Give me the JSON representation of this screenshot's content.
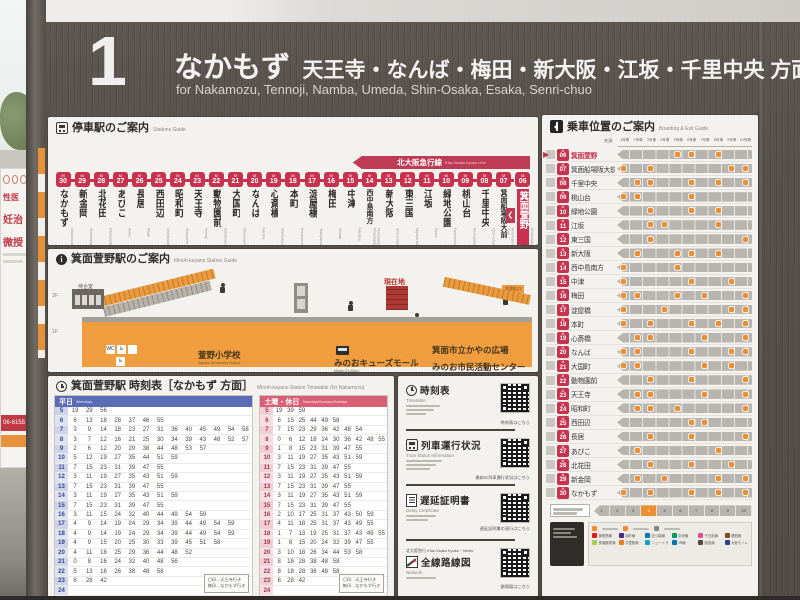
{
  "header": {
    "platform_number": "1",
    "destination_main": "なかもず",
    "destination_rest": "天王寺・なんば・梅田・新大阪・江坂・千里中央 方面",
    "destination_en": "for Nakamozu, Tennoji, Namba, Umeda, Shin-Osaka, Esaka, Senri-chuo"
  },
  "scene": {
    "poster_fragments": [
      "性医",
      "妊治",
      "微授"
    ],
    "poster_phone": "06-6155"
  },
  "route_panel": {
    "title": "停車駅のご案内",
    "title_en": "Stations Guide",
    "banner": "北大阪急行線",
    "banner_en": "Kita-Osaka Kyuko Line",
    "chevron": "❮",
    "stations": [
      {
        "num": "30",
        "name": "なかもず",
        "roma": "Nakamozu",
        "transfers": [
          "#2f6db5",
          "#8a8884"
        ]
      },
      {
        "num": "29",
        "name": "新金岡",
        "roma": "Shinkanaoka",
        "transfers": []
      },
      {
        "num": "28",
        "name": "北花田",
        "roma": "Kitahanada",
        "transfers": []
      },
      {
        "num": "27",
        "name": "あびこ",
        "roma": "Abiko",
        "transfers": []
      },
      {
        "num": "26",
        "name": "長居",
        "roma": "Nagai",
        "transfers": [
          "#0072bc"
        ]
      },
      {
        "num": "25",
        "name": "西田辺",
        "roma": "Nishitanabe",
        "transfers": []
      },
      {
        "num": "24",
        "name": "昭和町",
        "roma": "Showacho",
        "transfers": []
      },
      {
        "num": "23",
        "name": "天王寺",
        "roma": "Tennoji",
        "transfers": [
          "#0072bc",
          "#8f3e97",
          "#e5a21e",
          "#c8324e"
        ]
      },
      {
        "num": "22",
        "name": "動物園前",
        "roma": "Dobutsuen-mae",
        "transfers": [
          "#814721",
          "#e44d93",
          "#0072bc"
        ]
      },
      {
        "num": "21",
        "name": "大国町",
        "roma": "Daikokucho",
        "transfers": [
          "#0078ba"
        ]
      },
      {
        "num": "20",
        "name": "なんば",
        "roma": "Namba",
        "transfers": [
          "#0078ba",
          "#e44d93",
          "#005bac",
          "#0072bc",
          "#8c6e1e"
        ]
      },
      {
        "num": "19",
        "name": "心斎橋",
        "roma": "Shinsaibashi",
        "transfers": [
          "#a9cc51",
          "#d5c92a",
          "#0078ba"
        ]
      },
      {
        "num": "18",
        "name": "本町",
        "roma": "Hommachi",
        "transfers": [
          "#019a66",
          "#0078ba"
        ]
      },
      {
        "num": "17",
        "name": "淀屋橋",
        "roma": "Yodoyabashi",
        "transfers": [
          "#1d6fb7"
        ]
      },
      {
        "num": "16",
        "name": "梅田",
        "roma": "Umeda",
        "transfers": [
          "#0d3d8c",
          "#0072bc",
          "#59493f",
          "#c5242c"
        ]
      },
      {
        "num": "15",
        "name": "中津",
        "roma": "Nakatsu",
        "transfers": []
      },
      {
        "num": "14",
        "name": "西中島南方",
        "roma": "Nishinakajima-Minamigata",
        "transfers": [
          "#59493f",
          "#8a8884"
        ]
      },
      {
        "num": "13",
        "name": "新大阪",
        "roma": "Shin-Osaka",
        "transfers": [
          "#0072bc",
          "#00427e"
        ]
      },
      {
        "num": "12",
        "name": "東三国",
        "roma": "Higashi-Mikuni",
        "transfers": []
      },
      {
        "num": "11",
        "name": "江坂",
        "roma": "Esaka",
        "transfers": []
      },
      {
        "num": "10",
        "name": "緑地公園",
        "roma": "Ryokuchi-koen",
        "transfers": []
      },
      {
        "num": "09",
        "name": "桃山台",
        "roma": "Momoyamadai",
        "transfers": []
      },
      {
        "num": "08",
        "name": "千里中央",
        "roma": "Senri-Chuo",
        "transfers": [
          "#2f3f8f"
        ]
      },
      {
        "num": "07",
        "name": "箕面船場阪大前",
        "roma": "Minoh-semba Handai-mae",
        "transfers": []
      },
      {
        "num": "06",
        "name": "箕面萱野",
        "roma": "Minoh-kayano",
        "transfers": [],
        "current": true
      }
    ]
  },
  "map_panel": {
    "title": "箕面萱野駅のご案内",
    "title_en": "Minoh-kayano Station Guide",
    "floor2": "2F",
    "floor1": "1F",
    "current": "現在地",
    "waiting": "待合室",
    "south_gate": "南改札口",
    "south_gate_en": "South Gates",
    "north_gate": "北改札口",
    "north_gate_en": "North Gates",
    "north_tag": "北改札口",
    "school": "萱野小学校",
    "school_en": "Kayano Elementary School",
    "mall": "みのおキューズモール",
    "mall_en": "Minoh Q's MALL",
    "square": "箕面市立かやの広場",
    "center": "みのお市民活動センター",
    "wc": "WC",
    "wheelchair": "♿"
  },
  "timetable": {
    "title": "箕面萱野駅 時刻表［なかもず 方面］",
    "title_en": "Minoh-kayano Station Timetable (for Nakamozu)",
    "revision": "2024.3.23改正",
    "legend": [
      "〇印…天王寺行き",
      "無印…なかもず行き"
    ],
    "weekday": {
      "label": "平日",
      "label_en": "Weekdays",
      "rows": [
        {
          "hour": "5",
          "mins": [
            19,
            29,
            56
          ]
        },
        {
          "hour": "6",
          "mins": [
            6,
            13,
            18,
            28,
            37,
            46,
            55
          ]
        },
        {
          "hour": "7",
          "mins": [
            3,
            9,
            14,
            18,
            23,
            27,
            31,
            36,
            40,
            45,
            49,
            54,
            58
          ]
        },
        {
          "hour": "8",
          "mins": [
            3,
            7,
            12,
            16,
            21,
            25,
            30,
            34,
            39,
            43,
            48,
            52,
            57
          ]
        },
        {
          "hour": "9",
          "mins": [
            2,
            6,
            12,
            20,
            29,
            38,
            44,
            48,
            53,
            57
          ]
        },
        {
          "hour": "10",
          "mins": [
            5,
            12,
            19,
            27,
            35,
            44,
            51,
            59
          ]
        },
        {
          "hour": "11",
          "mins": [
            7,
            15,
            23,
            31,
            39,
            47,
            55
          ]
        },
        {
          "hour": "12",
          "mins": [
            3,
            11,
            19,
            27,
            35,
            43,
            51,
            59
          ]
        },
        {
          "hour": "13",
          "mins": [
            7,
            15,
            23,
            31,
            39,
            47,
            55
          ]
        },
        {
          "hour": "14",
          "mins": [
            3,
            11,
            19,
            27,
            35,
            43,
            51,
            59
          ]
        },
        {
          "hour": "15",
          "mins": [
            7,
            15,
            23,
            31,
            39,
            47,
            55
          ]
        },
        {
          "hour": "16",
          "mins": [
            3,
            11,
            15,
            24,
            32,
            40,
            44,
            49,
            54,
            59
          ]
        },
        {
          "hour": "17",
          "mins": [
            4,
            9,
            14,
            19,
            24,
            29,
            34,
            39,
            44,
            49,
            54,
            59
          ]
        },
        {
          "hour": "18",
          "mins": [
            4,
            9,
            14,
            19,
            24,
            29,
            34,
            39,
            44,
            49,
            54,
            59
          ]
        },
        {
          "hour": "19",
          "mins": [
            4,
            9,
            15,
            20,
            25,
            30,
            33,
            39,
            45,
            51,
            58
          ]
        },
        {
          "hour": "20",
          "mins": [
            4,
            11,
            18,
            25,
            29,
            36,
            44,
            48,
            52
          ]
        },
        {
          "hour": "21",
          "mins": [
            0,
            8,
            16,
            24,
            32,
            40,
            48,
            56
          ]
        },
        {
          "hour": "22",
          "mins": [
            5,
            13,
            16,
            26,
            38,
            48,
            58
          ]
        },
        {
          "hour": "23",
          "mins": [
            8,
            28,
            42
          ]
        },
        {
          "hour": "24",
          "mins": []
        }
      ]
    },
    "holiday": {
      "label": "土曜・休日",
      "label_en": "Saturdays/Sundays/Holidays",
      "rows": [
        {
          "hour": "5",
          "mins": [
            19,
            39,
            59
          ]
        },
        {
          "hour": "6",
          "mins": [
            6,
            15,
            25,
            44,
            49,
            58
          ]
        },
        {
          "hour": "7",
          "mins": [
            7,
            15,
            23,
            29,
            36,
            42,
            48,
            54
          ]
        },
        {
          "hour": "8",
          "mins": [
            0,
            6,
            12,
            18,
            24,
            30,
            36,
            42,
            48,
            55
          ]
        },
        {
          "hour": "9",
          "mins": [
            1,
            8,
            15,
            23,
            31,
            39,
            47,
            55
          ]
        },
        {
          "hour": "10",
          "mins": [
            3,
            11,
            19,
            27,
            35,
            43,
            51,
            59
          ]
        },
        {
          "hour": "11",
          "mins": [
            7,
            15,
            23,
            31,
            39,
            47,
            55
          ]
        },
        {
          "hour": "12",
          "mins": [
            3,
            11,
            19,
            27,
            35,
            43,
            51,
            59
          ]
        },
        {
          "hour": "13",
          "mins": [
            7,
            15,
            23,
            31,
            39,
            47,
            55
          ]
        },
        {
          "hour": "14",
          "mins": [
            3,
            11,
            19,
            27,
            35,
            43,
            51,
            59
          ]
        },
        {
          "hour": "15",
          "mins": [
            7,
            15,
            23,
            31,
            39,
            47,
            55
          ]
        },
        {
          "hour": "16",
          "mins": [
            2,
            10,
            17,
            25,
            31,
            37,
            43,
            50,
            59
          ]
        },
        {
          "hour": "17",
          "mins": [
            4,
            11,
            18,
            25,
            31,
            37,
            43,
            49,
            55
          ]
        },
        {
          "hour": "18",
          "mins": [
            1,
            7,
            13,
            19,
            25,
            31,
            37,
            43,
            49,
            55
          ]
        },
        {
          "hour": "19",
          "mins": [
            1,
            8,
            15,
            20,
            24,
            32,
            39,
            47,
            55
          ]
        },
        {
          "hour": "20",
          "mins": [
            3,
            10,
            18,
            26,
            34,
            44,
            53,
            58
          ]
        },
        {
          "hour": "21",
          "mins": [
            8,
            18,
            28,
            38,
            48,
            58
          ]
        },
        {
          "hour": "22",
          "mins": [
            8,
            18,
            28,
            38,
            48,
            58
          ]
        },
        {
          "hour": "23",
          "mins": [
            8,
            28,
            42
          ]
        },
        {
          "hour": "24",
          "mins": []
        }
      ]
    }
  },
  "qr": {
    "cards": [
      {
        "icon": "clock-icon",
        "title": "時刻表",
        "en": "Timetable",
        "caption": "時刻表はこちら"
      },
      {
        "icon": "train-icon",
        "title": "列車運行状況",
        "en": "Train Status Information",
        "caption": "最新の列車運行状況はこちら"
      },
      {
        "icon": "document-icon",
        "title": "遅延証明書",
        "en": "Delay Certificate",
        "caption": "遅延証明書の発行はこちら"
      },
      {
        "icon": "map-icon",
        "pre": "北大阪急行 Kita-Osaka Kyuko・Metro",
        "title": "全線路線図",
        "en": "Network",
        "caption": "路線図はこちら"
      }
    ]
  },
  "boarding": {
    "title": "乗車位置のご案内",
    "title_en": "Boarding & Exit Guide",
    "front_label": "先頭",
    "car_labels": [
      "1号車",
      "2号車",
      "3号車",
      "4号車",
      "5号車",
      "6号車",
      "7号車",
      "8号車",
      "9号車",
      "10号車"
    ],
    "rows": [
      {
        "num": "06",
        "name": "箕面萱野",
        "current": true,
        "markers": [
          5,
          6,
          8
        ]
      },
      {
        "num": "07",
        "name": "箕面船場阪大前",
        "markers": [
          1,
          3,
          9,
          10
        ]
      },
      {
        "num": "08",
        "name": "千里中央",
        "markers": [
          2,
          3,
          6,
          8,
          10
        ]
      },
      {
        "num": "09",
        "name": "桃山台",
        "markers": [
          1,
          2,
          6
        ]
      },
      {
        "num": "10",
        "name": "緑地公園",
        "markers": [
          3,
          6,
          8
        ]
      },
      {
        "num": "11",
        "name": "江坂",
        "markers": [
          3,
          4,
          8
        ]
      },
      {
        "num": "12",
        "name": "東三国",
        "markers": [
          3,
          10
        ]
      },
      {
        "num": "13",
        "name": "新大阪",
        "markers": [
          2,
          5,
          6,
          8
        ]
      },
      {
        "num": "14",
        "name": "西中島南方",
        "markers": [
          1,
          5
        ]
      },
      {
        "num": "15",
        "name": "中津",
        "markers": [
          1,
          6,
          9
        ]
      },
      {
        "num": "16",
        "name": "梅田",
        "markers": [
          1,
          2,
          5,
          7,
          10
        ]
      },
      {
        "num": "17",
        "name": "淀屋橋",
        "markers": [
          1,
          4,
          9,
          10
        ]
      },
      {
        "num": "18",
        "name": "本町",
        "markers": [
          1,
          3,
          6,
          8,
          10
        ]
      },
      {
        "num": "19",
        "name": "心斎橋",
        "markers": [
          2,
          3,
          7,
          10
        ]
      },
      {
        "num": "20",
        "name": "なんば",
        "markers": [
          1,
          2,
          6,
          9,
          10
        ]
      },
      {
        "num": "21",
        "name": "大国町",
        "markers": [
          1,
          2,
          7,
          9
        ]
      },
      {
        "num": "22",
        "name": "動物園前",
        "markers": [
          3,
          6,
          10
        ]
      },
      {
        "num": "23",
        "name": "天王寺",
        "markers": [
          2,
          3,
          7,
          10
        ]
      },
      {
        "num": "24",
        "name": "昭和町",
        "markers": [
          2,
          3,
          5,
          10
        ]
      },
      {
        "num": "25",
        "name": "西田辺",
        "markers": [
          6,
          7
        ]
      },
      {
        "num": "26",
        "name": "長居",
        "markers": [
          3,
          6,
          10
        ]
      },
      {
        "num": "27",
        "name": "あびこ",
        "markers": [
          2,
          8
        ]
      },
      {
        "num": "28",
        "name": "北花田",
        "markers": [
          3,
          6,
          9
        ]
      },
      {
        "num": "29",
        "name": "新金岡",
        "markers": [
          2,
          4,
          8,
          10
        ]
      },
      {
        "num": "30",
        "name": "なかもず",
        "markers": [
          1,
          3,
          6,
          8,
          10
        ]
      }
    ],
    "legend_lines": [
      {
        "name": "御堂筋線",
        "color": "#e5171f"
      },
      {
        "name": "谷町線",
        "color": "#522886"
      },
      {
        "name": "四つ橋線",
        "color": "#0078ba"
      },
      {
        "name": "中央線",
        "color": "#019a66"
      },
      {
        "name": "千日前線",
        "color": "#e44d93"
      },
      {
        "name": "堺筋線",
        "color": "#814721"
      },
      {
        "name": "長堀鶴見緑地線",
        "color": "#a9cc51"
      },
      {
        "name": "今里筋線",
        "color": "#ee7b1a"
      },
      {
        "name": "ニュートラム",
        "color": "#10a5c7"
      },
      {
        "name": "JR線",
        "color": "#0072bc"
      },
      {
        "name": "阪急線",
        "color": "#59493f"
      },
      {
        "name": "大阪モノレール",
        "color": "#2f3f8f"
      }
    ]
  },
  "colors": {
    "line_red": "#c8324e",
    "banner_red": "#bf3a55",
    "board_gray": "#56504b",
    "panel_white": "#f4f2ee",
    "weekday_blue": "#5a6cb4",
    "holiday_pink": "#d95f75",
    "map_orange": "#ef9d3f",
    "marker_orange": "#ee8f2f"
  }
}
